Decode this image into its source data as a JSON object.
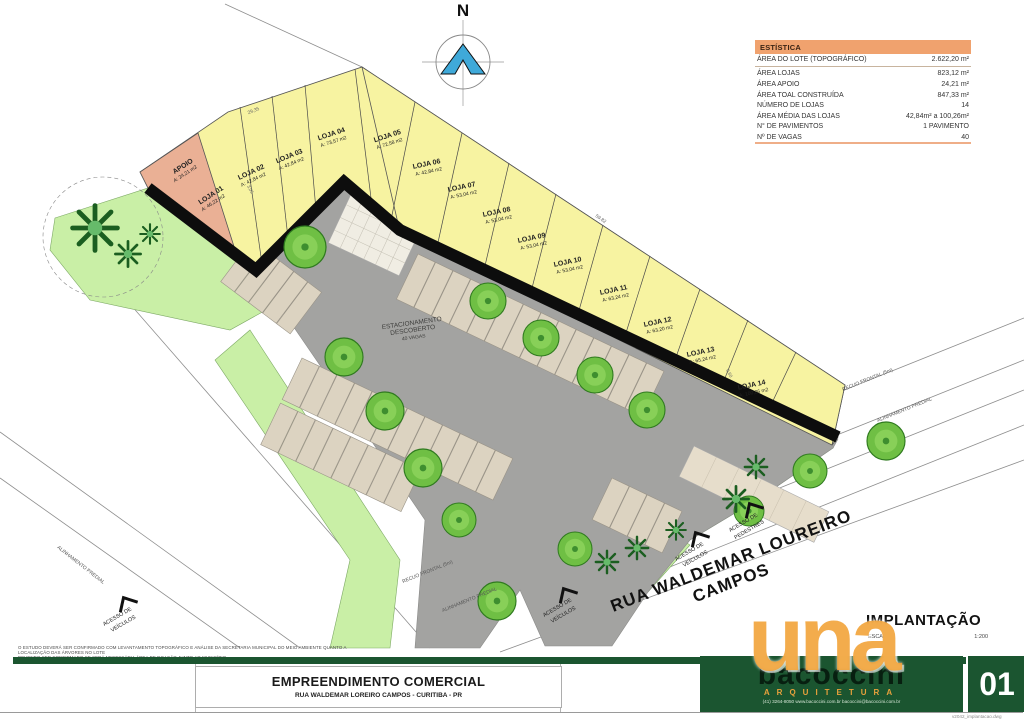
{
  "north": {
    "label": "N"
  },
  "stats": {
    "title": "ESTÍSTICA",
    "rows": [
      {
        "label": "ÁREA DO LOTE (TOPOGRÁFICO)",
        "value": "2.622,20 m²"
      },
      {
        "label": "ÁREA LOJAS",
        "value": "823,12 m²"
      },
      {
        "label": "ÁREA APOIO",
        "value": "24,21 m²"
      },
      {
        "label": "ÁREA TOAL CONSTRUÍDA",
        "value": "847,33 m²"
      },
      {
        "label": "NÚMERO DE LOJAS",
        "value": "14"
      },
      {
        "label": "ÁREA MÉDIA DAS LOJAS",
        "value": "42,84m² a 100,26m²"
      },
      {
        "label": "N° DE PAVIMENTOS",
        "value": "1 PAVIMENTO"
      },
      {
        "label": "Nº DE VAGAS",
        "value": "40"
      }
    ]
  },
  "plan": {
    "apoio": {
      "name": "APOIO",
      "area": "A: 24,21 m2"
    },
    "lojas": [
      {
        "name": "LOJA 01",
        "area": "A: 46,22 m2"
      },
      {
        "name": "LOJA 02",
        "area": "A: 42,84 m2"
      },
      {
        "name": "LOJA 03",
        "area": "A: 42,84 m2"
      },
      {
        "name": "LOJA 04",
        "area": "A: 73,57 m2"
      },
      {
        "name": "LOJA 05",
        "area": "A: 72,58 m2"
      },
      {
        "name": "LOJA 06",
        "area": "A: 42,84 m2"
      },
      {
        "name": "LOJA 07",
        "area": "A: 53,04 m2"
      },
      {
        "name": "LOJA 08",
        "area": "A: 53,04 m2"
      },
      {
        "name": "LOJA 09",
        "area": "A: 53,04 m2"
      },
      {
        "name": "LOJA 10",
        "area": "A: 53,04 m2"
      },
      {
        "name": "LOJA 11",
        "area": "A: 63,24 m2"
      },
      {
        "name": "LOJA 12",
        "area": "A: 63,20 m2"
      },
      {
        "name": "LOJA 13",
        "area": "A: 65,24 m2"
      },
      {
        "name": "LOJA 14",
        "area": "A: 100,26 m2"
      }
    ],
    "parking": {
      "line1": "ESTACIONAMENTO",
      "line2": "DESCOBERTO",
      "line3": "40 VAGAS"
    },
    "street": {
      "line1": "RUA WALDEMAR LOUREIRO",
      "line2": "CAMPOS"
    },
    "access": {
      "vehicles_line1": "ACESSO DE",
      "vehicles_line2": "VEÍCULOS",
      "pedestrians_line1": "ACESSO DE",
      "pedestrians_line2": "PEDESTRES"
    },
    "boundaries": {
      "recuo": "RECUO FRONTAL (5m)",
      "alinhamento": "ALINHAMENTO PREDIAL"
    },
    "dimensions": {
      "d1": "29,35",
      "d2": "59,82",
      "d3": "3,05",
      "d4": "0,60"
    }
  },
  "titleblock": {
    "note_line1": "O ESTUDO DEVERÁ SER CONFIRMADO COM LEVANTAMENTO TOPOGRÁFICO E ANÁLISE DA SECRETARIA MUNICIPAL DO MEIO AMBIENTE QUANTO A LOCALIZAÇÃO DAS ÁRVORES NO LOTE",
    "note_line2": "DEVENDO SER CONFIRMADO SE SERÁ NECESSÁRIA ÁREA DE DOAÇÃO JUNTO AO MUNICÍPIO",
    "project": "EMPREENDIMENTO COMERCIAL",
    "address": "RUA WALDEMAR LOREIRO CAMPOS - CURITIBA - PR",
    "sheet": {
      "title": "IMPLANTAÇÃO",
      "scale_label": "ESCALA",
      "scale_value": "1:200",
      "number": "01"
    },
    "firm": {
      "name": "bacoccini",
      "tagline": "ARQUITETURA",
      "contact": "(41) 3264-8050   www.bacoccini.com.br   bacoccini@bacoccini.com.br",
      "watermark": "una"
    },
    "file": "v2042_implantacao.dwg"
  },
  "colors": {
    "loja_fill": "#f7f3a1",
    "apoio_fill": "#eab095",
    "wall": "#0d0d0d",
    "parking": "#a3a3a1",
    "stall": "#dcd3c1",
    "green": "#c9efa6",
    "stats_header": "#f0a26e",
    "brand_green": "#1b5530",
    "brand_orange": "#f2a338",
    "north_blue": "#3fa9d9"
  }
}
